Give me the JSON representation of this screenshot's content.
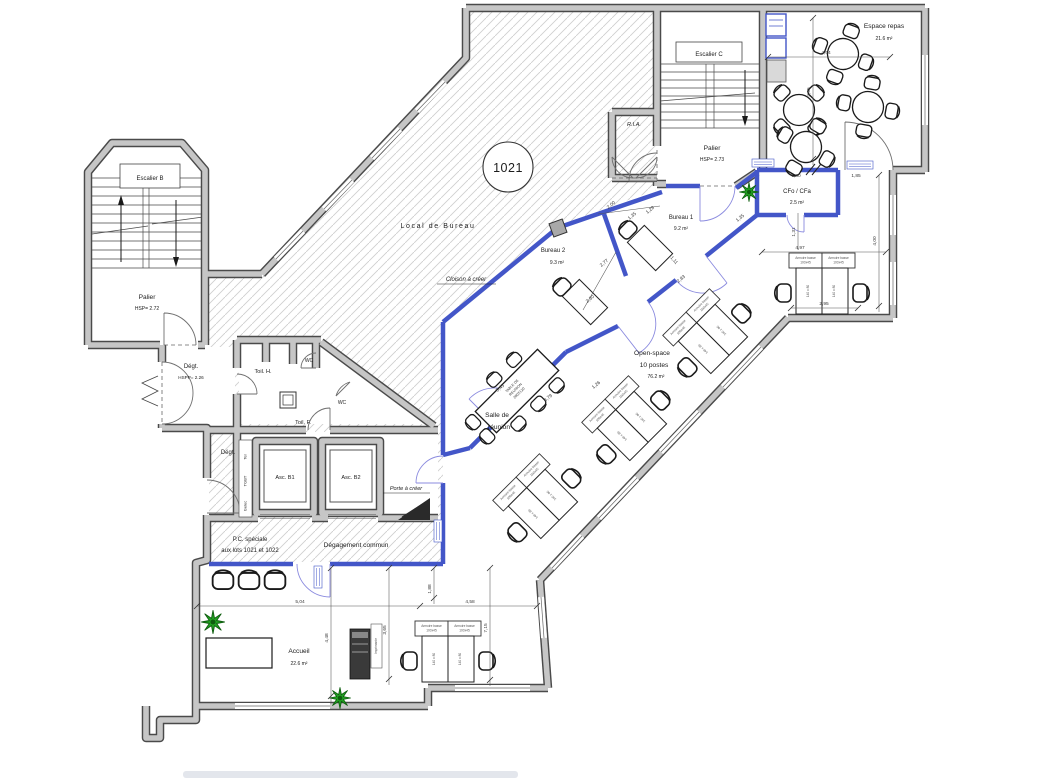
{
  "title": "Plan du lot 1021 - plateau de bureaux",
  "lot": {
    "number": "1021"
  },
  "colors": {
    "existing_wall": "#c6c6c6",
    "wall_edge": "#4a4a4a",
    "new_partition_blue": "#4356c8",
    "plant_green": "#21a121",
    "hatch_gray": "#cfcfcf"
  },
  "rooms": {
    "local_bureau": "Local  de  Bureau",
    "escalier_b": "Escalier B",
    "palier_b": "Palier",
    "palier_b_hsp": "HSP= 2.72",
    "escalier_c": "Escalier C",
    "palier_c": "Palier",
    "palier_c_hsp": "HSP= 2.73",
    "ria": "R.I.A.",
    "espace_repas": "Espace repas",
    "espace_repas_area": "21.6 m²",
    "cfo_cfa": "CFo / CFa",
    "cfo_cfa_area": "2.5 m²",
    "bureau_1": "Bureau 1",
    "bureau_1_area": "9.2 m²",
    "bureau_2": "Bureau 2",
    "bureau_2_area": "9.3 m²",
    "open_space": "Open-space",
    "open_space_postes": "10 postes",
    "open_space_area": "76.2 m²",
    "salle_reunion_l1": "Salle de",
    "salle_reunion_l2": "réunion",
    "degt_entree": "Dégt.",
    "degt_entree_hsp": "HSPP= 2.26",
    "toil_h": "Toil. H.",
    "toil_f": "Toil. F.",
    "wc_1": "WC",
    "wc_2": "WC",
    "degt_2": "Dégt.",
    "asc_b1": "Asc. B1",
    "asc_b2": "Asc. B2",
    "pc_l1": "P.C. spéciale",
    "pc_l2": "aux lots 1021 et 1022",
    "degagement_commun": "Dégagement commun",
    "accueil": "Accueil",
    "accueil_area": "22.6 m²"
  },
  "annotations": {
    "cloison_a_creer": "Cloison à créer",
    "porte_a_creer": "Porte à créer",
    "table_reunion_l1": "TABLE DE",
    "table_reunion_l2": "REUNION",
    "table_reunion_l3": "280X120",
    "tel": "Tel",
    "tgbt": "TGBT",
    "gelec": "Gelec",
    "imprimante": "Imprimante",
    "armoire_l1": "Armoire basse",
    "armoire_l2": "100x45",
    "desk_size": "140 x 80"
  },
  "dims": {
    "d504": "5,04",
    "d458": "4,58",
    "d448": "4,48",
    "d365": "3,65",
    "d188": "1,88",
    "d715": "7,15",
    "d295": "2,95",
    "d497": "4,97",
    "d400": "4,00",
    "d131": "1,31",
    "d180": "1,80",
    "d185": "1,85",
    "d464": "4,64",
    "d465": "4,65",
    "d200": "2,00",
    "d135": "1,35",
    "d128": "1,28",
    "d277": "2,77",
    "d230": "2,30",
    "d379": "3,79",
    "d545": "5,45",
    "d111": "1,11",
    "d283": "2,83",
    "d126": "1,26",
    "d135b": "1,35"
  }
}
